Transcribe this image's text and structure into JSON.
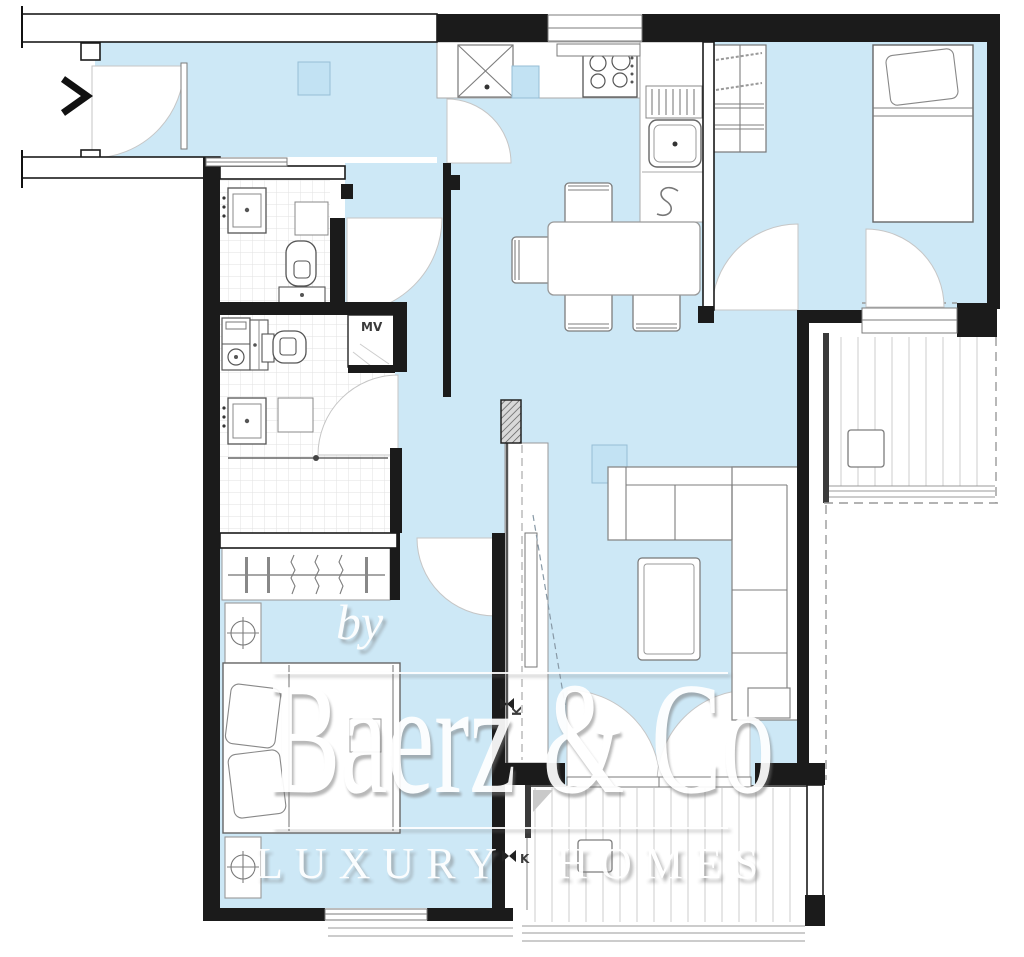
{
  "watermark": {
    "by": "by",
    "brand": "Baerz & Co",
    "tagline": "LUXURY HOMES"
  },
  "labels": {
    "mechanical_ventilation": "MV",
    "tap_hall": "K",
    "tap_terrace": "K"
  },
  "colors": {
    "floor_blue": "#cde8f6",
    "wall": "#1b1b1b",
    "furniture": "#7d7d7d",
    "tile_line": "#e2e2e2",
    "deck_line": "#cccccc",
    "dashed_line": "#9a9a9a",
    "watermark_white": "#ffffff"
  },
  "icons": {
    "entrance_arrow": "chevron-right",
    "tap_symbol": "bowtie-valve",
    "lamp_symbol": "circle-cross",
    "boiler_symbol": "s-curve"
  }
}
